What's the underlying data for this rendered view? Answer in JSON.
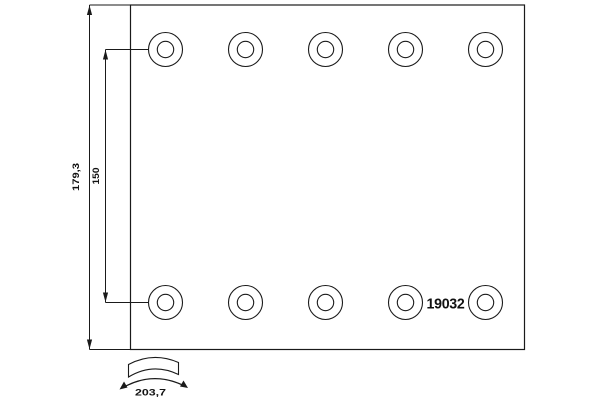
{
  "drawing": {
    "type": "brake-lining-technical-drawing",
    "part_number": "19032",
    "dimensions": {
      "height": "179,3",
      "hole_row_spacing": "150",
      "arc_length": "203,7"
    },
    "holes": {
      "rows": 2,
      "per_row": 5
    },
    "colors": {
      "line": "#1a1a1a",
      "background": "#ffffff"
    }
  }
}
